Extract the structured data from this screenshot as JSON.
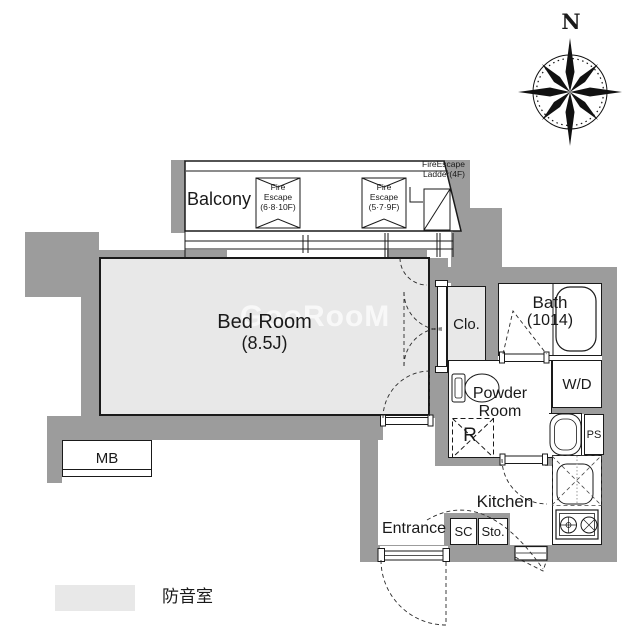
{
  "plan": {
    "compass_label": "N",
    "watermark": "GooRooM",
    "balcony": {
      "label": "Balcony"
    },
    "fire_escape_hatch_1": {
      "line1": "Fire",
      "line2": "Escape",
      "line3": "(6·8·10F)"
    },
    "fire_escape_hatch_2": {
      "line1": "Fire",
      "line2": "Escape",
      "line3": "(5·7·9F)"
    },
    "fire_escape_ladder": {
      "line1": "FireEscape",
      "line2": "Ladder(4F)"
    },
    "rooms": {
      "bedroom": {
        "name": "Bed Room",
        "size": "(8.5J)"
      },
      "closet": {
        "label": "Clo."
      },
      "bath": {
        "name": "Bath",
        "size": "(1014)"
      },
      "powder_room": {
        "line1": "Powder",
        "line2": "Room"
      },
      "washer_dryer": {
        "label": "W/D"
      },
      "pipe_space": {
        "label": "PS"
      },
      "refrigerator": {
        "label": "R"
      },
      "kitchen": {
        "label": "Kitchen"
      },
      "entrance": {
        "label": "Entrance"
      },
      "shoe_closet": {
        "label": "SC"
      },
      "storage": {
        "label": "Sto."
      },
      "meter_box": {
        "label": "MB"
      }
    },
    "legend": {
      "label": "防音室",
      "swatch_color": "#e8e8e8"
    },
    "colors": {
      "wall": "#9c9c9c",
      "soundproof_fill": "#e8e8e8",
      "line": "#1a1a1a"
    }
  }
}
